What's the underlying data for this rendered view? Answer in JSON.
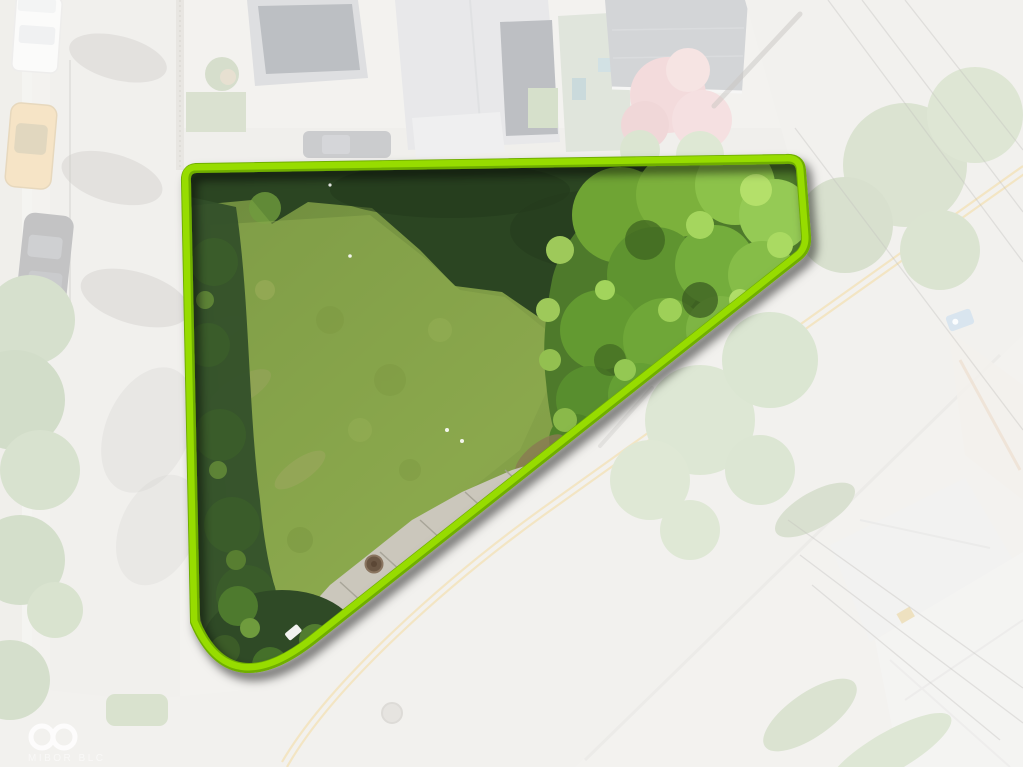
{
  "watermark": {
    "text": "MIBOR BLC",
    "icon": "infinity-icon"
  },
  "colors": {
    "boundary_green": "#97DC00",
    "boundary_green_bright": "#A8E81A",
    "grass": "#85A249",
    "shadow_green": "#2B4522",
    "tree_green": "#4E7A2B",
    "concrete": "#CBC7BC",
    "road": "#D6D3CB",
    "centerline_yellow": "#D9AE45",
    "pink_tree": "#D98F92",
    "car_yellow": "#E2AC4E",
    "fade_overlay": "rgba(255,255,255,0.68)",
    "watermark_white": "#FFFFFF"
  }
}
